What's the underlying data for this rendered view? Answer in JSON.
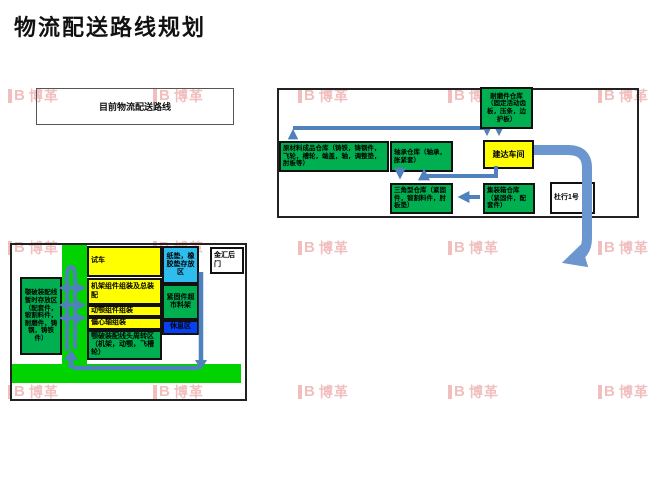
{
  "title": "物流配送路线规划",
  "legend": {
    "current_route": "目前物流配送路线"
  },
  "watermark": {
    "mark": "B",
    "text": "博革"
  },
  "colors": {
    "arrow": "#4f81bd",
    "arrowLight": "#6b96cf",
    "greenBox": "#00b050",
    "road": "#00d300",
    "yellow": "#ffff00",
    "lightBlue": "#2fbdee",
    "blue": "#0541f0",
    "wm": "rgba(224,110,110,0.45)"
  },
  "factory1": {
    "boxes": {
      "wear": {
        "label": "耐磨件仓库（固定活动齿板，压条，边护板）"
      },
      "raw": {
        "label": "原材料成品仓库（铸铁，铸钢件，飞轮，槽轮，端盖，轴，调整垫，肘板等）"
      },
      "bearing": {
        "label": "轴承仓库（轴承，胀紧套）"
      },
      "jianda": {
        "label": "建达车间"
      },
      "triangle": {
        "label": "三角型仓库（紧固件，锻割料件，肘板垫）"
      },
      "container": {
        "label": "集装箱仓库（紧固件，配套件）"
      },
      "duhang": {
        "label": "杜行1号"
      }
    }
  },
  "factory2": {
    "boxes": {
      "staging": {
        "label": "颚破装配线暂时存放区（配套件，锻割料件，耐磨件，铸钢，铸铁件）"
      },
      "test": {
        "label": "试车"
      },
      "frame": {
        "label": "机架组件组装及总装配"
      },
      "jaw": {
        "label": "动颚组件组装"
      },
      "shaft": {
        "label": "偏心轴组装"
      },
      "turnover": {
        "label": "颚破装配线头周转区（机架，动颚，飞槽轮）"
      },
      "pads": {
        "label": "纸垫，橡胶垫存放区"
      },
      "market": {
        "label": "紧固件超市料架"
      },
      "rest": {
        "label": "休息区"
      },
      "gate": {
        "label": "金汇后门"
      }
    }
  }
}
